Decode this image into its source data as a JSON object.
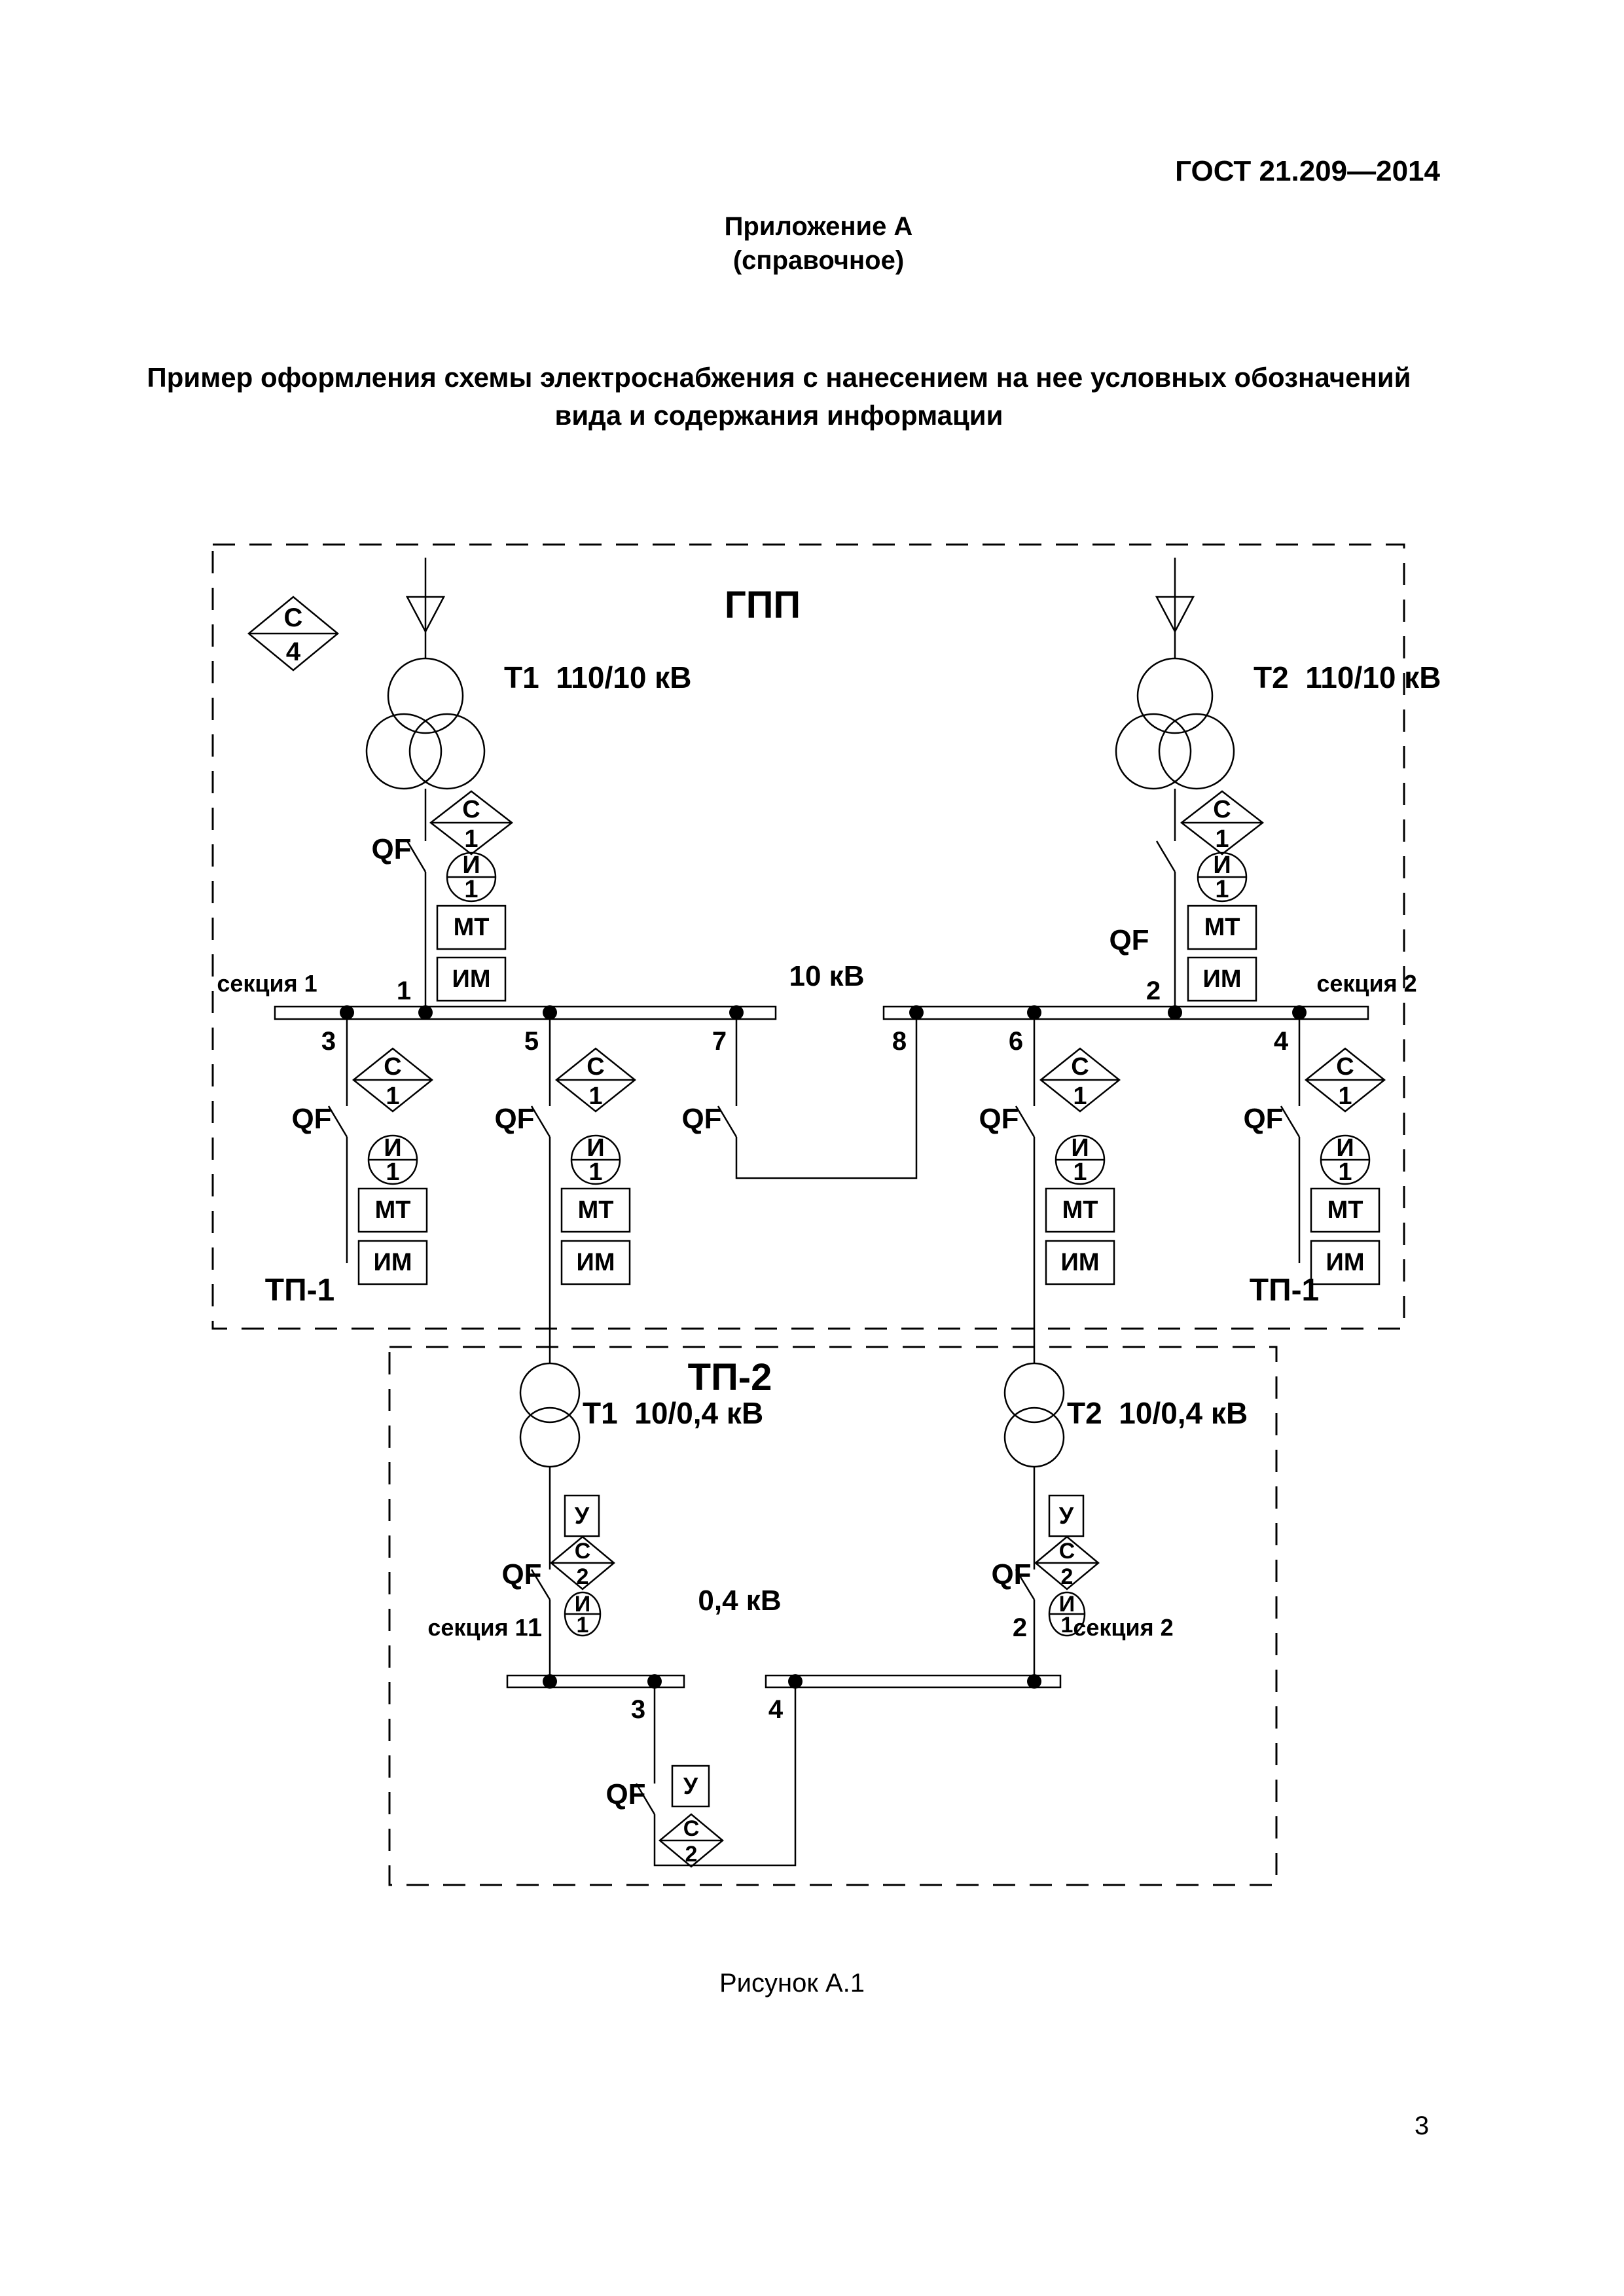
{
  "header": {
    "standard": "ГОСТ 21.209—2014",
    "appendix": "Приложение А",
    "appendix_note": "(справочное)",
    "title_line1": "Пример оформления схемы электроснабжения с нанесением на нее условных обозначений",
    "title_line2": "вида и содержания информации"
  },
  "diagram": {
    "gpp": {
      "title": "ГПП",
      "transformer1": "Т1  110/10 кВ",
      "transformer2": "Т2  110/10 кВ",
      "voltage": "10 кВ",
      "section1": "секция 1",
      "section2": "секция 2",
      "tp1_left": "ТП-1",
      "tp1_right": "ТП-1",
      "nodes": {
        "n1": "1",
        "n2": "2",
        "n3": "3",
        "n4": "4",
        "n5": "5",
        "n6": "6",
        "n7": "7",
        "n8": "8"
      }
    },
    "tp2": {
      "title": "ТП-2",
      "transformer1": "Т1  10/0,4 кВ",
      "transformer2": "Т2  10/0,4 кВ",
      "voltage": "0,4 кВ",
      "section1": "секция 1",
      "section2": "секция 2",
      "nodes": {
        "n1": "1",
        "n2": "2",
        "n3": "3",
        "n4": "4"
      }
    },
    "symbols": {
      "breaker": "QF",
      "s": "С",
      "i": "И",
      "one": "1",
      "two": "2",
      "four": "4",
      "mt": "МТ",
      "im": "ИМ",
      "u": "У"
    },
    "colors": {
      "ink": "#000000",
      "paper": "#ffffff"
    }
  },
  "caption": "Рисунок А.1",
  "page_number": "3"
}
